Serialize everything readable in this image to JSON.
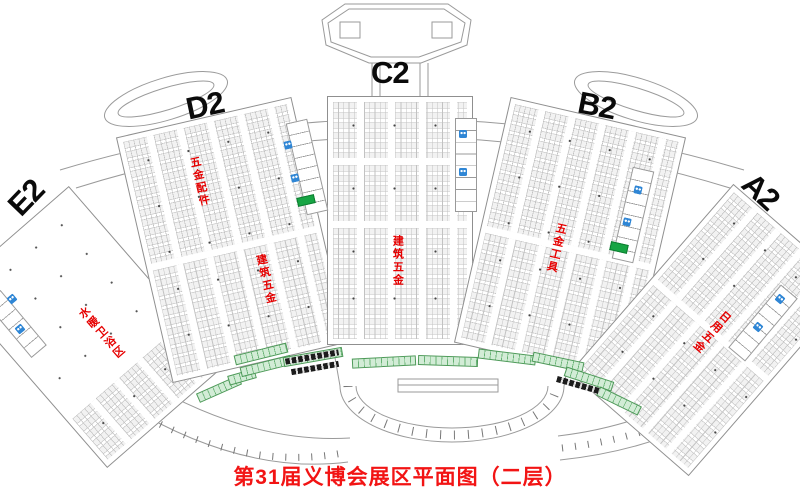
{
  "caption": "第31届义博会展区平面图（二层）",
  "halls": {
    "A2": {
      "letter": "A2",
      "zones": [
        "日用五金"
      ]
    },
    "B2": {
      "letter": "B2",
      "zones": [
        "五金工具"
      ]
    },
    "C2": {
      "letter": "C2",
      "zones": [
        "建筑五金"
      ]
    },
    "D2": {
      "letter": "D2",
      "zones": [
        "五金配件",
        "建筑五金"
      ]
    },
    "E2": {
      "letter": "E2",
      "zones": [
        "水暖卫浴区"
      ]
    }
  },
  "colors": {
    "zone_label_red": "#e60000",
    "caption_red": "#f21414",
    "hall_letter_black": "#0a0a0a",
    "restroom_blue": "#2f86d5",
    "escalator_green": "#17a544",
    "booth_strip_green": "#66b273",
    "outline_gray": "#9a9a9a"
  }
}
